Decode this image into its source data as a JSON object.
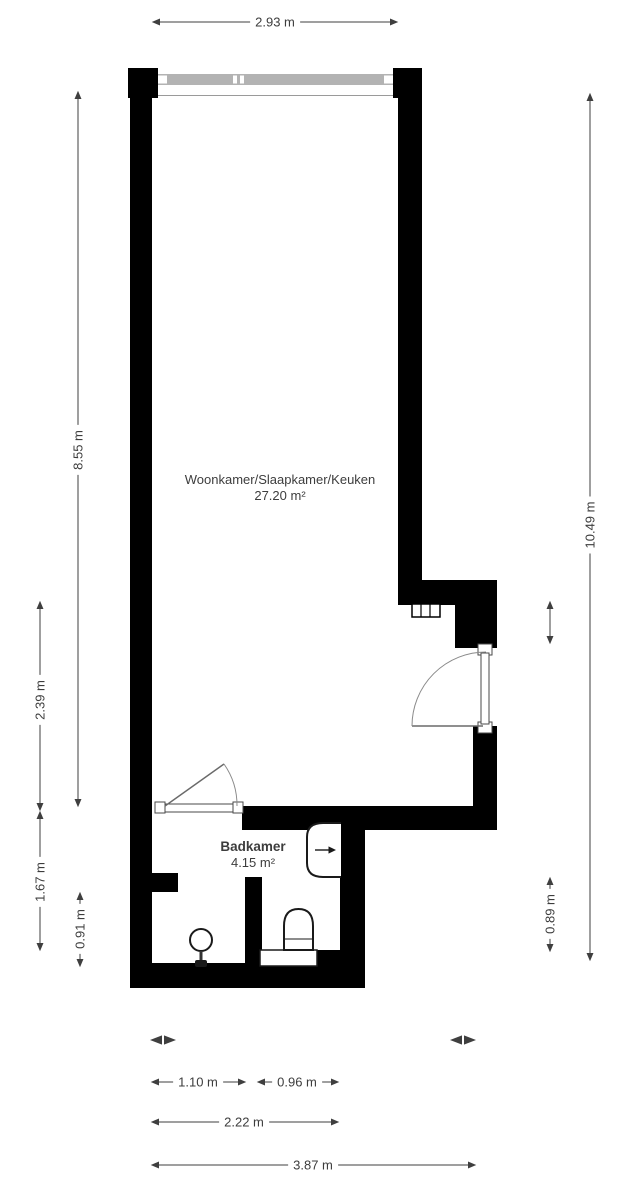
{
  "colors": {
    "wall": "#000000",
    "window_glass": "#b3b3b3",
    "dimension": "#3f3f3f",
    "text": "#3d3d3d",
    "background": "#ffffff",
    "fixture": "#1a1a1a"
  },
  "rooms": {
    "living": {
      "name": "Woonkamer/Slaapkamer/Keuken",
      "area": "27.20 m²"
    },
    "bathroom": {
      "name": "Badkamer",
      "area": "4.15 m²"
    }
  },
  "dimensions": {
    "top_width": "2.93 m",
    "left_living_height": "8.55 m",
    "left_lower_height": "2.39 m",
    "left_bathroom_height": "1.67 m",
    "left_shower_height": "0.91 m",
    "right_total_height": "10.49 m",
    "right_toilet_height": "0.89 m",
    "bottom_shower_width": "1.10 m",
    "bottom_toilet_width": "0.96 m",
    "bottom_bathroom_width": "2.22 m",
    "bottom_total_width": "3.87 m"
  }
}
